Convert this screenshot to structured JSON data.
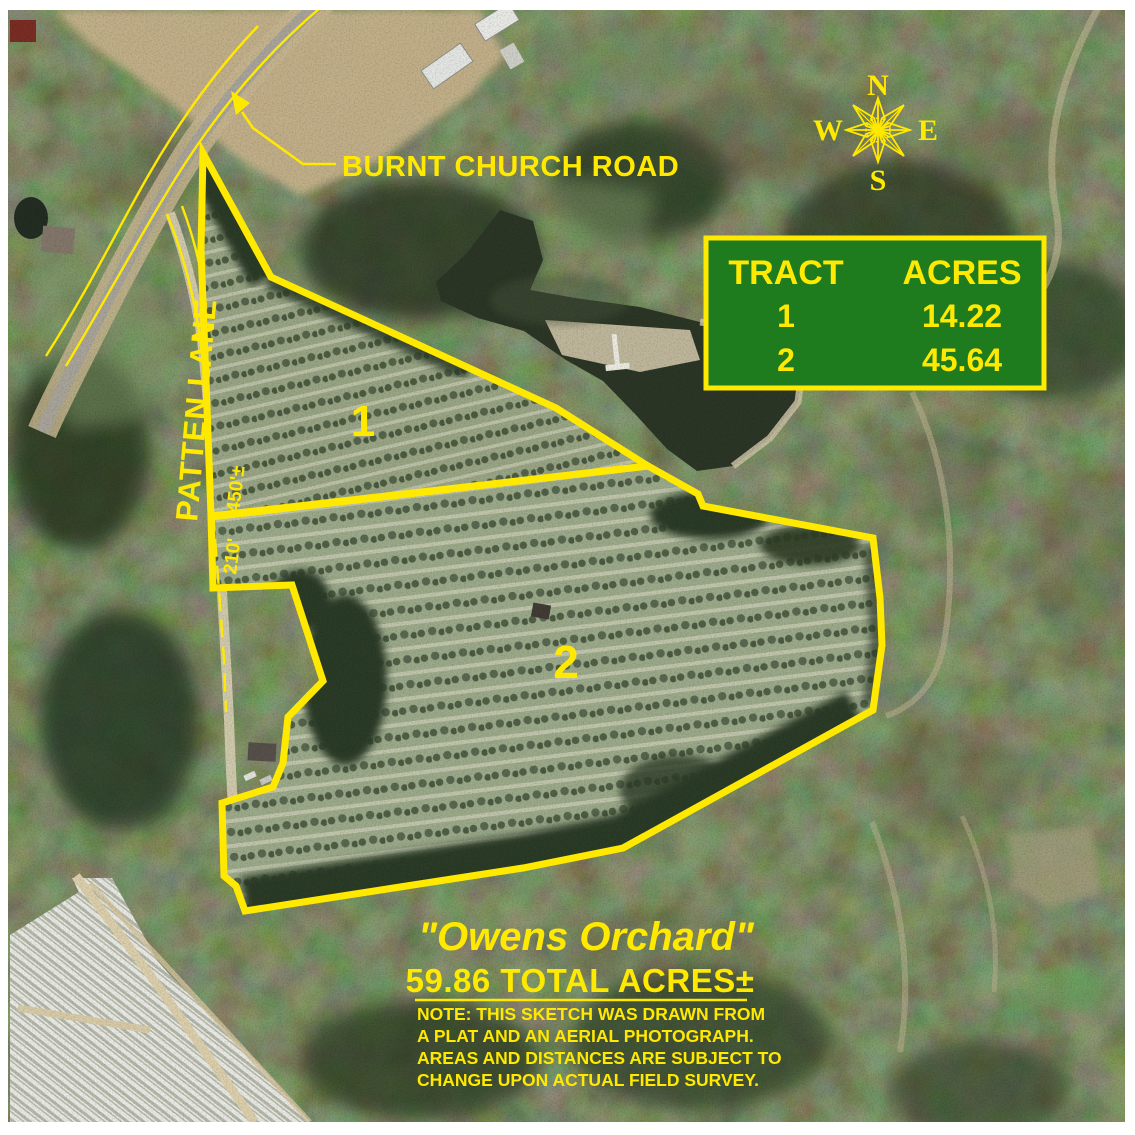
{
  "annotations": {
    "road_label": "BURNT CHURCH ROAD",
    "lane_label": "PATTEN LANE",
    "dim_450": "450'±",
    "dim_210": "210'",
    "tract1_label": "1",
    "tract2_label": "2"
  },
  "compass": {
    "north": "N",
    "east": "E",
    "south": "S",
    "west": "W"
  },
  "table": {
    "header_tract": "TRACT",
    "header_acres": "ACRES",
    "rows": [
      {
        "tract": "1",
        "acres": "14.22"
      },
      {
        "tract": "2",
        "acres": "45.64"
      }
    ]
  },
  "title_block": {
    "title": "\"Owens Orchard\"",
    "total_acres": "59.86 TOTAL ACRES±",
    "note_lines": [
      "NOTE: THIS SKETCH WAS DRAWN FROM",
      "A PLAT AND AN AERIAL PHOTOGRAPH.",
      "AREAS AND DISTANCES ARE SUBJECT TO",
      "CHANGE UPON ACTUAL FIELD SURVEY."
    ]
  },
  "colors": {
    "annotation_yellow": "#ffe900",
    "table_green": "#1e7b1e",
    "table_border": "#ffe900",
    "forest_green": "#2e3d28",
    "orchard_green": "#98a484",
    "pond_water": "#2c3626"
  }
}
